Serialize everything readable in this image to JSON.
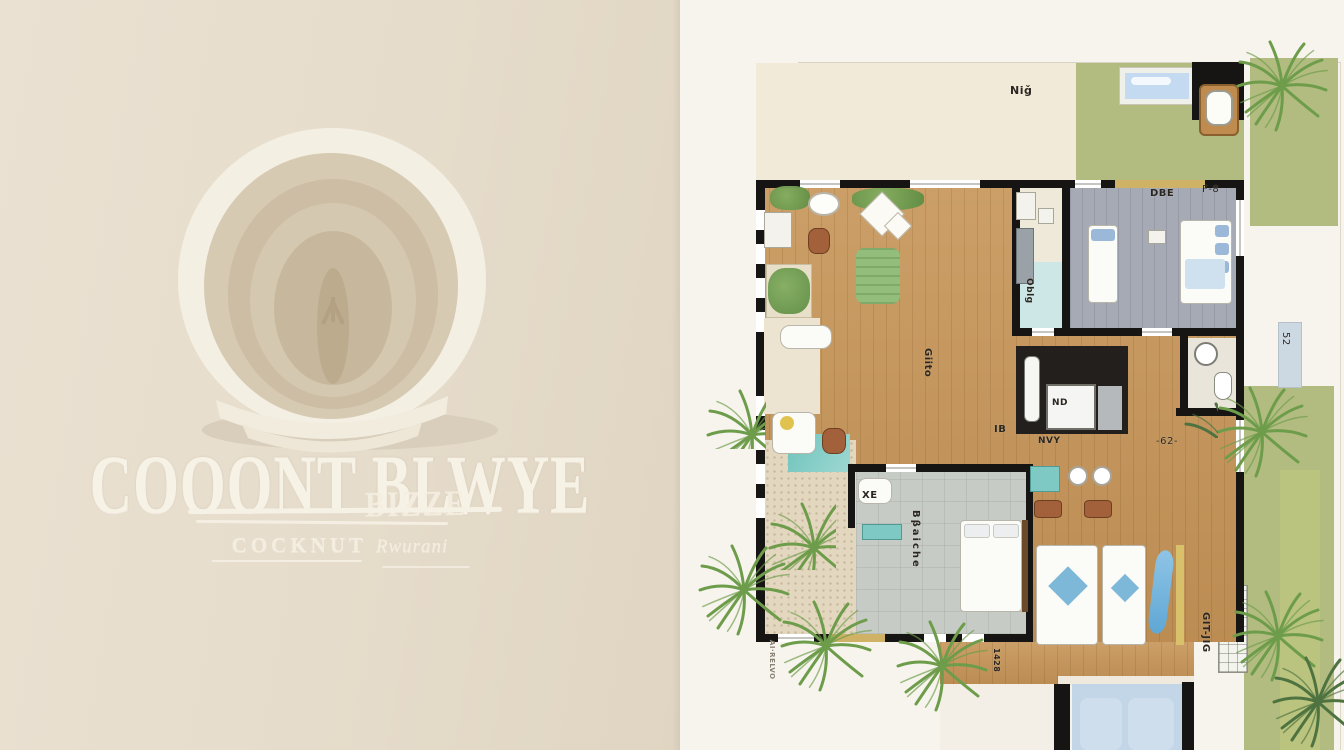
{
  "branding": {
    "title": "COOONT BLWYE",
    "title_fragment": "BIZZE",
    "subtitle_word1": "COCKNUT",
    "subtitle_word2": "Rwurani",
    "icon": "coconut-illustration",
    "colors": {
      "background": "#e6dccb",
      "lettering": "#f7f2e6"
    }
  },
  "floor_plan": {
    "labels": [
      {
        "id": "terrace",
        "text": "Niǧ"
      },
      {
        "id": "bedroom-ne",
        "text": "DBE"
      },
      {
        "id": "bedroom-ne-dim",
        "text": "F-8"
      },
      {
        "id": "pantry",
        "text": "Oblg"
      },
      {
        "id": "living",
        "text": "Giito"
      },
      {
        "id": "bath-center",
        "text": "IB"
      },
      {
        "id": "bath-tray",
        "text": "ND"
      },
      {
        "id": "bath-mat",
        "text": "NVY"
      },
      {
        "id": "hallway",
        "text": "-62-"
      },
      {
        "id": "walkway",
        "text": "52"
      },
      {
        "id": "armchair",
        "text": "XE"
      },
      {
        "id": "bedroom-sw",
        "text": "Bβaiche"
      },
      {
        "id": "patio",
        "text": "GIT-JIG"
      },
      {
        "id": "deck",
        "text": "1428"
      },
      {
        "id": "beach",
        "text": "AI·RELVO"
      }
    ],
    "colors": {
      "plan_background": "#f7f4ed",
      "lawn": "#b2bc80",
      "wood_floor": "#c49459",
      "wall": "#171513",
      "pool": "#c2d6e8",
      "plunge_pool": "#7fc9c4",
      "bedroom_gray": "#a6aab5",
      "palm": "#6d9c4a",
      "door_gold": "#cfb266"
    }
  }
}
